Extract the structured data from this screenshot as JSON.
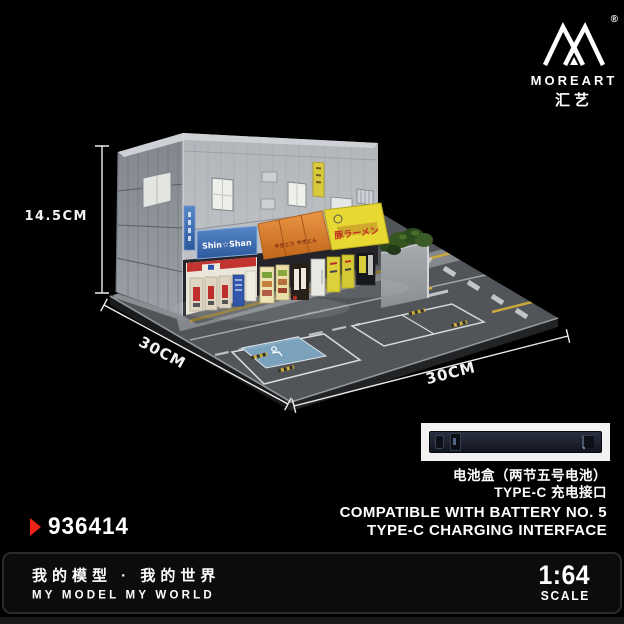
{
  "brand": {
    "name": "MOREART",
    "chinese_name": "汇艺",
    "registered_mark": "®",
    "logo_icon": "mountain-peaks-icon"
  },
  "product_photo": {
    "dimension_height": "14.5CM",
    "dimension_depth": "30CM",
    "dimension_width": "30CM",
    "storefront_signs": {
      "convenience_store": "Shin☆Shan",
      "awning": "やきとり やきとん",
      "ramen": "豚ラーメン"
    }
  },
  "battery_section": {
    "caption_cn_line1": "电池盒（两节五号电池）",
    "caption_cn_line2": "TYPE-C 充电接口",
    "caption_en_line1": "COMPATIBLE WITH BATTERY NO. 5",
    "caption_en_line2": "TYPE-C CHARGING INTERFACE"
  },
  "product_number": "936414",
  "footer": {
    "slogan_cn": "我的模型 · 我的世界",
    "slogan_en": "MY MODEL MY WORLD",
    "scale_ratio": "1:64",
    "scale_label": "SCALE"
  },
  "colors": {
    "background": "#000000",
    "accent_red": "#ee2419",
    "dimension_line": "#ededed",
    "sign_blue": "#3a6cb4",
    "awning_orange": "#d97a28",
    "sign_yellow": "#e7d834"
  }
}
